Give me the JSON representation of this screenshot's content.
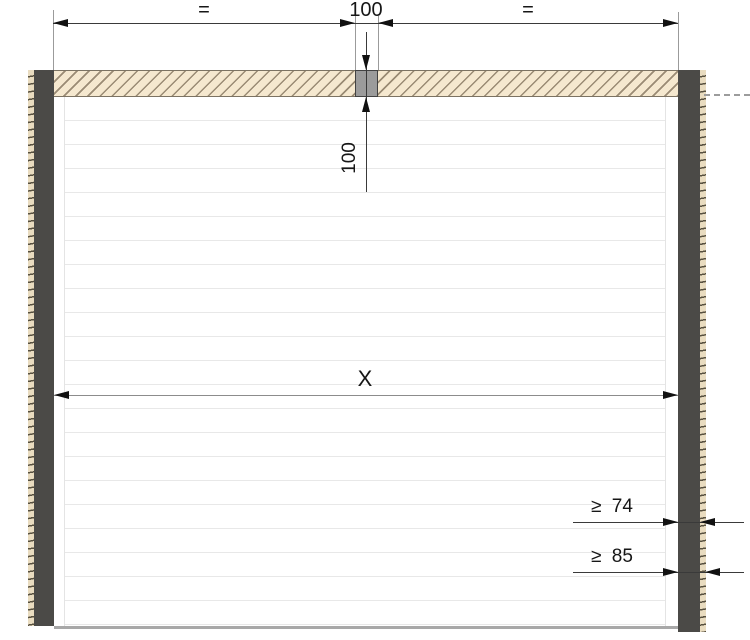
{
  "drawing": {
    "description": "Sectional door frame cross-section with dimension lines",
    "labels": {
      "top_equal_left": "=",
      "top_anchor_width": "100",
      "top_equal_right": "=",
      "lintel_anchor_depth": "100",
      "door_clear_width": "X",
      "frame_min_74": "≥ 74",
      "frame_min_85": "≥ 85"
    },
    "colors": {
      "frame_post": "#4b4a47",
      "plaster_strip": "#e9dcc0",
      "lintel_fill": "#f5e8cf",
      "lintel_hatch": "#9a8b74",
      "anchor_block": "#9b9b9b",
      "dimension_line": "#3a3a3a",
      "extension_line": "#9b9b9b",
      "slat_line": "#e8e8e8",
      "floor_line": "#a8a8a8",
      "text": "#161616"
    }
  }
}
